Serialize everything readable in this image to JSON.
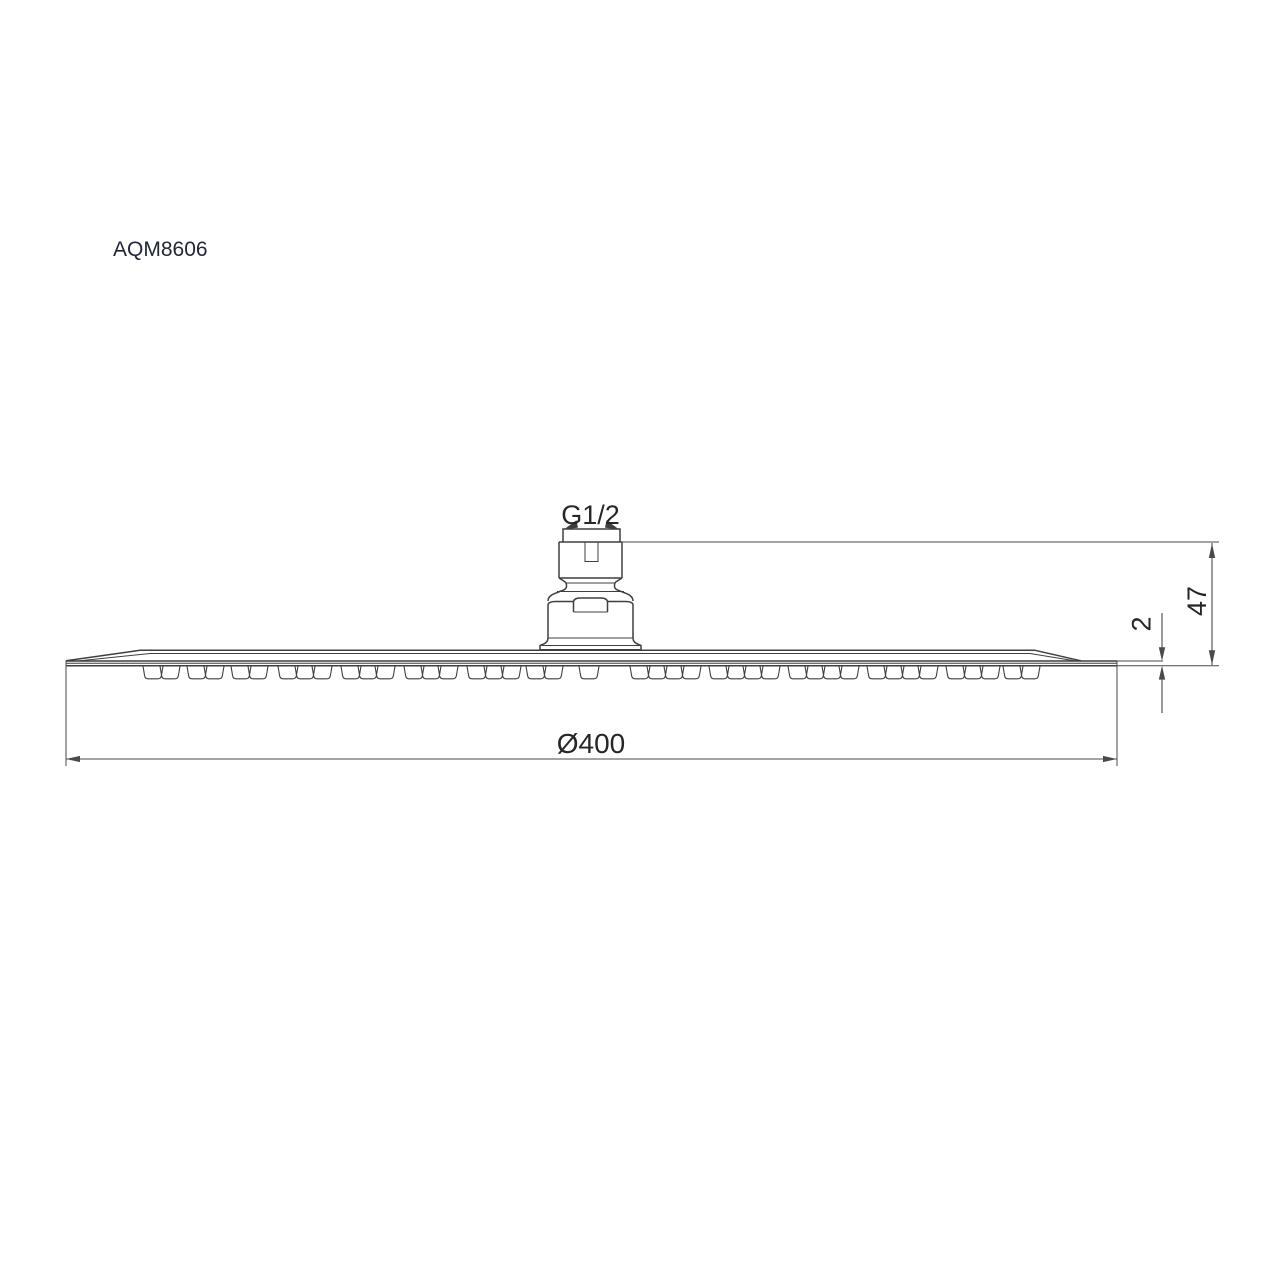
{
  "drawing": {
    "model_number": "AQM8606",
    "annotations": {
      "thread_size": "G1/2",
      "head_height": "47",
      "edge_thickness": "2",
      "head_diameter": "Ø400"
    },
    "colors": {
      "line": "#3f3f3f",
      "dimension": "#4a4a4a",
      "text": "#262626",
      "model_text": "#1f2637",
      "background": "#ffffff"
    }
  }
}
